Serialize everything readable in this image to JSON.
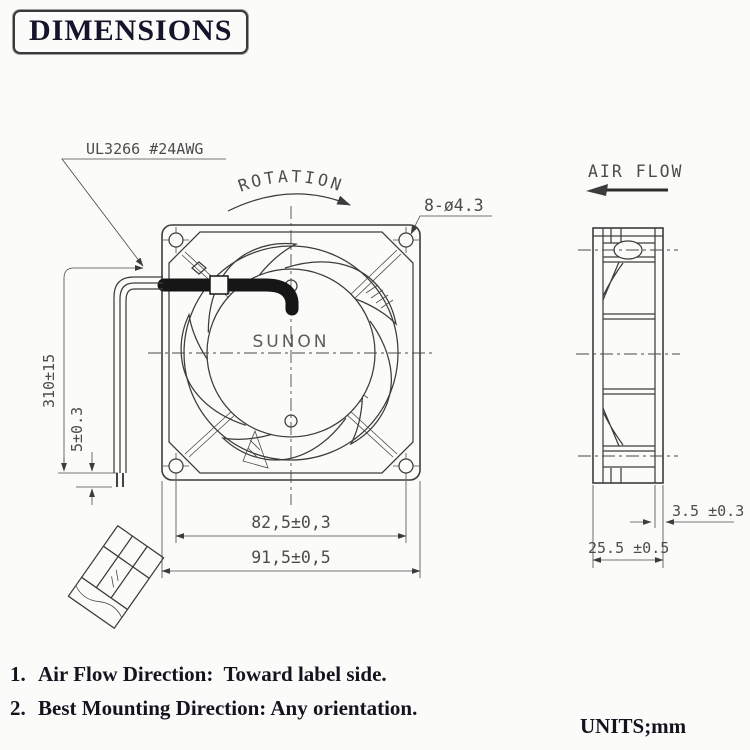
{
  "title": "DIMENSIONS",
  "front_view": {
    "brand": "SUNON",
    "wire_label": "UL3266 #24AWG",
    "rotation_label": "ROTATION",
    "mounting_holes_label": "8-ø4.3",
    "lead_wire_length": "310±15",
    "strip_length": "5±0.3",
    "hole_pitch": "82,5±0,3",
    "frame_size": "91,5±0,5"
  },
  "side_view": {
    "air_flow_label": "AIR FLOW",
    "flange_thickness": "3.5 ±0.3",
    "frame_depth": "25.5 ±0.5"
  },
  "notes": {
    "items": [
      {
        "num": "1.",
        "text": "Air Flow Direction:  Toward label side."
      },
      {
        "num": "2.",
        "text": "Best Mounting Direction: Any orientation."
      }
    ],
    "units": "UNITS;mm"
  }
}
